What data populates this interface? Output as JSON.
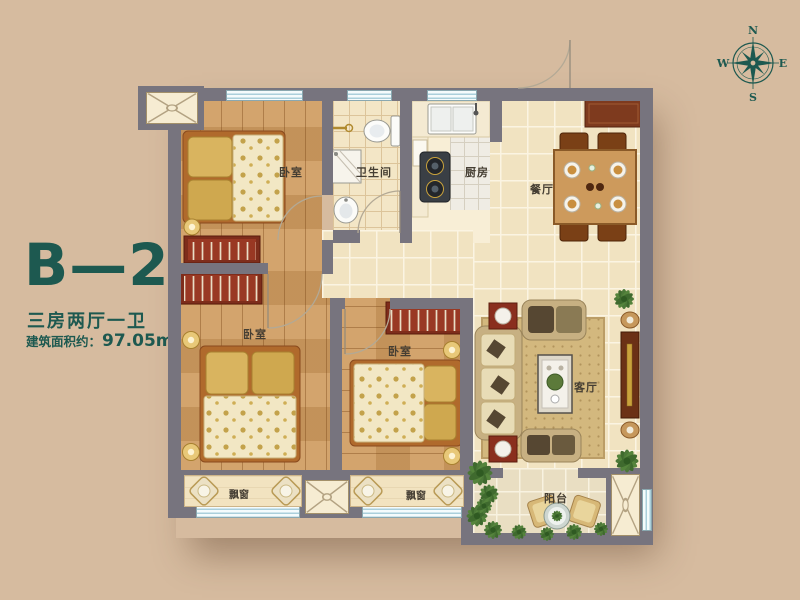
{
  "title": {
    "unit": "B—2",
    "layout": "三房两厅一卫",
    "area_prefix": "建筑面积约：",
    "area_value": "97.05m",
    "area_sup": "2"
  },
  "compass": {
    "north": "N",
    "south": "S",
    "east": "E",
    "west": "W"
  },
  "rooms": {
    "bedroom_top": "卧室",
    "bedroom_left": "卧室",
    "bedroom_mid": "卧室",
    "bathroom": "卫生间",
    "kitchen": "厨房",
    "dining": "餐厅",
    "living": "客厅",
    "balcony": "阳台",
    "bay_window_left": "飘窗",
    "bay_window_mid": "飘窗"
  },
  "colors": {
    "accent_teal": "#1d5950",
    "background_tan": "#d6bb9f",
    "wall_gray": "#77747e",
    "window_blue": "#aacfdb",
    "wood_floor": "#cf9b5f",
    "tile_floor": "#f1e3c1",
    "wardrobe_red": "#8f3420"
  }
}
